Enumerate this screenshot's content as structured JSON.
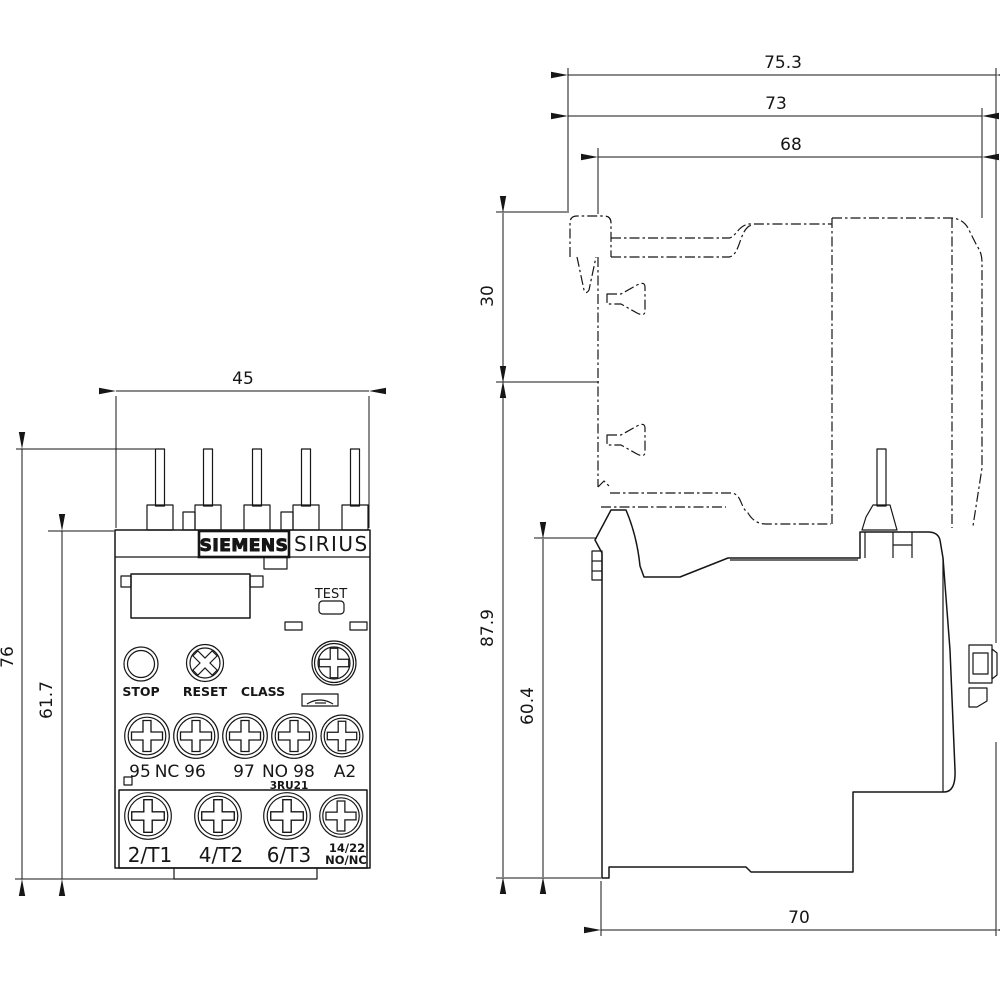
{
  "drawing": {
    "front": {
      "brand": "SIEMENS",
      "series": "SIRIUS",
      "test": "TEST",
      "stop": "STOP",
      "reset": "RESET",
      "class": "CLASS",
      "model": "3RU21",
      "row1": {
        "t95": "95",
        "nc": "NC",
        "t96": "96",
        "t97": "97",
        "no": "NO",
        "t98": "98",
        "a2": "A2"
      },
      "row2": {
        "t1": "2/T1",
        "t2": "4/T2",
        "t3": "6/T3",
        "aux1": "14/22",
        "aux2": "NO/NC"
      }
    },
    "dims": {
      "front_width": "45",
      "front_total_height": "76",
      "front_body_height": "61.7",
      "total_depth": "75.3",
      "depth_73": "73",
      "depth_68": "68",
      "rail_offset": "30",
      "total_height": "87.9",
      "body_height": "60.4",
      "bottom_depth": "70"
    },
    "line_color": "#161616",
    "background": "#ffffff"
  }
}
